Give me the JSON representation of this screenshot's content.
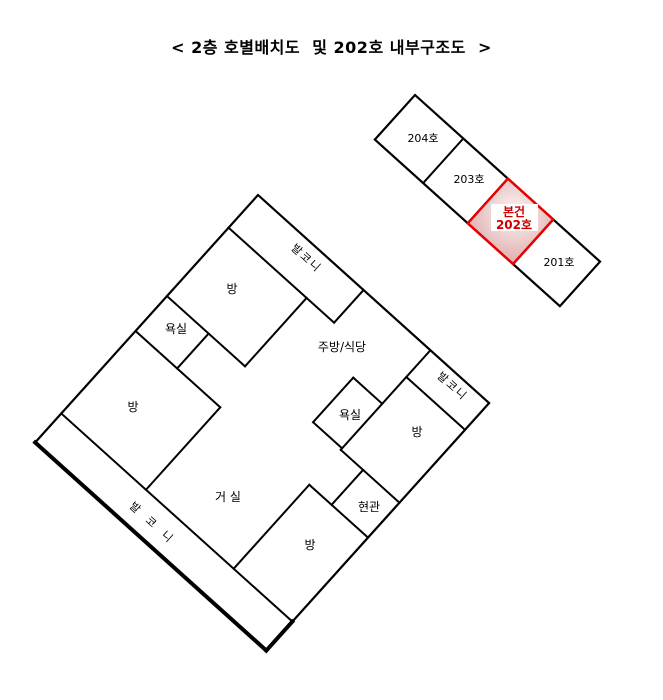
{
  "title": "< 2층 호별배치도  및 202호 내부구조도  >",
  "unit_strip": {
    "units": [
      {
        "label": "204호",
        "highlighted": false
      },
      {
        "label": "203호",
        "highlighted": false
      },
      {
        "label": "본건 202호",
        "line1": "본건",
        "line2": "202호",
        "highlighted": true
      },
      {
        "label": "201호",
        "highlighted": false
      }
    ]
  },
  "floor_plan": {
    "rooms": {
      "balcony_top": "발코니",
      "room_top": "방",
      "bath_left": "욕실",
      "room_left": "방",
      "kitchen_dining": "주방/식당",
      "bath_right": "욕실",
      "room_right": "방",
      "balcony_right": "발코니",
      "entrance": "현관",
      "room_bottom": "방",
      "living_room": "거 실",
      "balcony_bottom": "발 코 니"
    }
  },
  "colors": {
    "wall": "#000000",
    "text": "#000000",
    "highlight_border": "#e60000",
    "highlight_text": "#cc0000",
    "highlight_fill_light": "#fdf4f4",
    "highlight_fill_dark": "#e0b1b1",
    "label_box": "#ffffff",
    "background": "#ffffff"
  }
}
